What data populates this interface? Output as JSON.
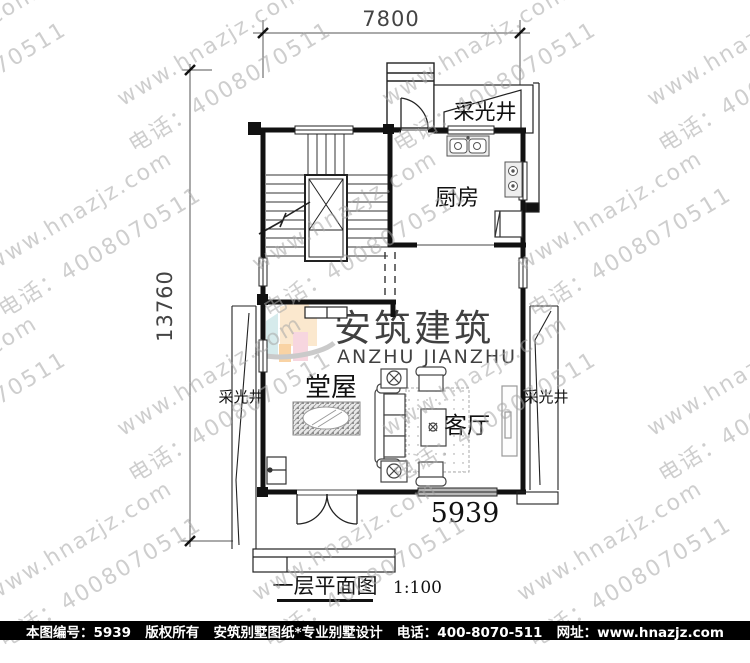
{
  "dimensions": {
    "top_width": "7800",
    "left_height": "13760"
  },
  "plan": {
    "drawing_number": "5939",
    "title": "一层平面图",
    "scale": "1:100",
    "rooms": {
      "kitchen": "厨房",
      "main_hall": "堂屋",
      "living_room": "客厅",
      "lightwell_top": "采光井",
      "lightwell_left": "采光井",
      "lightwell_right": "采光井"
    }
  },
  "logo": {
    "cn": "安筑建筑",
    "en": "ANZHU JIANZHU"
  },
  "watermark": {
    "line1": "www.hnazjz.com",
    "line2": "电话：4008070511"
  },
  "footer": {
    "id_label": "本图编号：5939",
    "copyright": "版权所有",
    "company": "安筑别墅图纸*专业别墅设计",
    "phone": "电话：400-8070-511",
    "site": "网址：www.hnazjz.com"
  },
  "colors": {
    "wall": "#111111",
    "watermark_gray": "#a5a5a5",
    "logo_gray": "#c6c6c6",
    "logo_peach": "#fbe3c3",
    "logo_cyan": "#cde7e8",
    "logo_orange": "#f8c98e",
    "logo_pink": "#f6ccd8",
    "footer_bg": "#000000",
    "window_gray": "#b8b8b8"
  }
}
